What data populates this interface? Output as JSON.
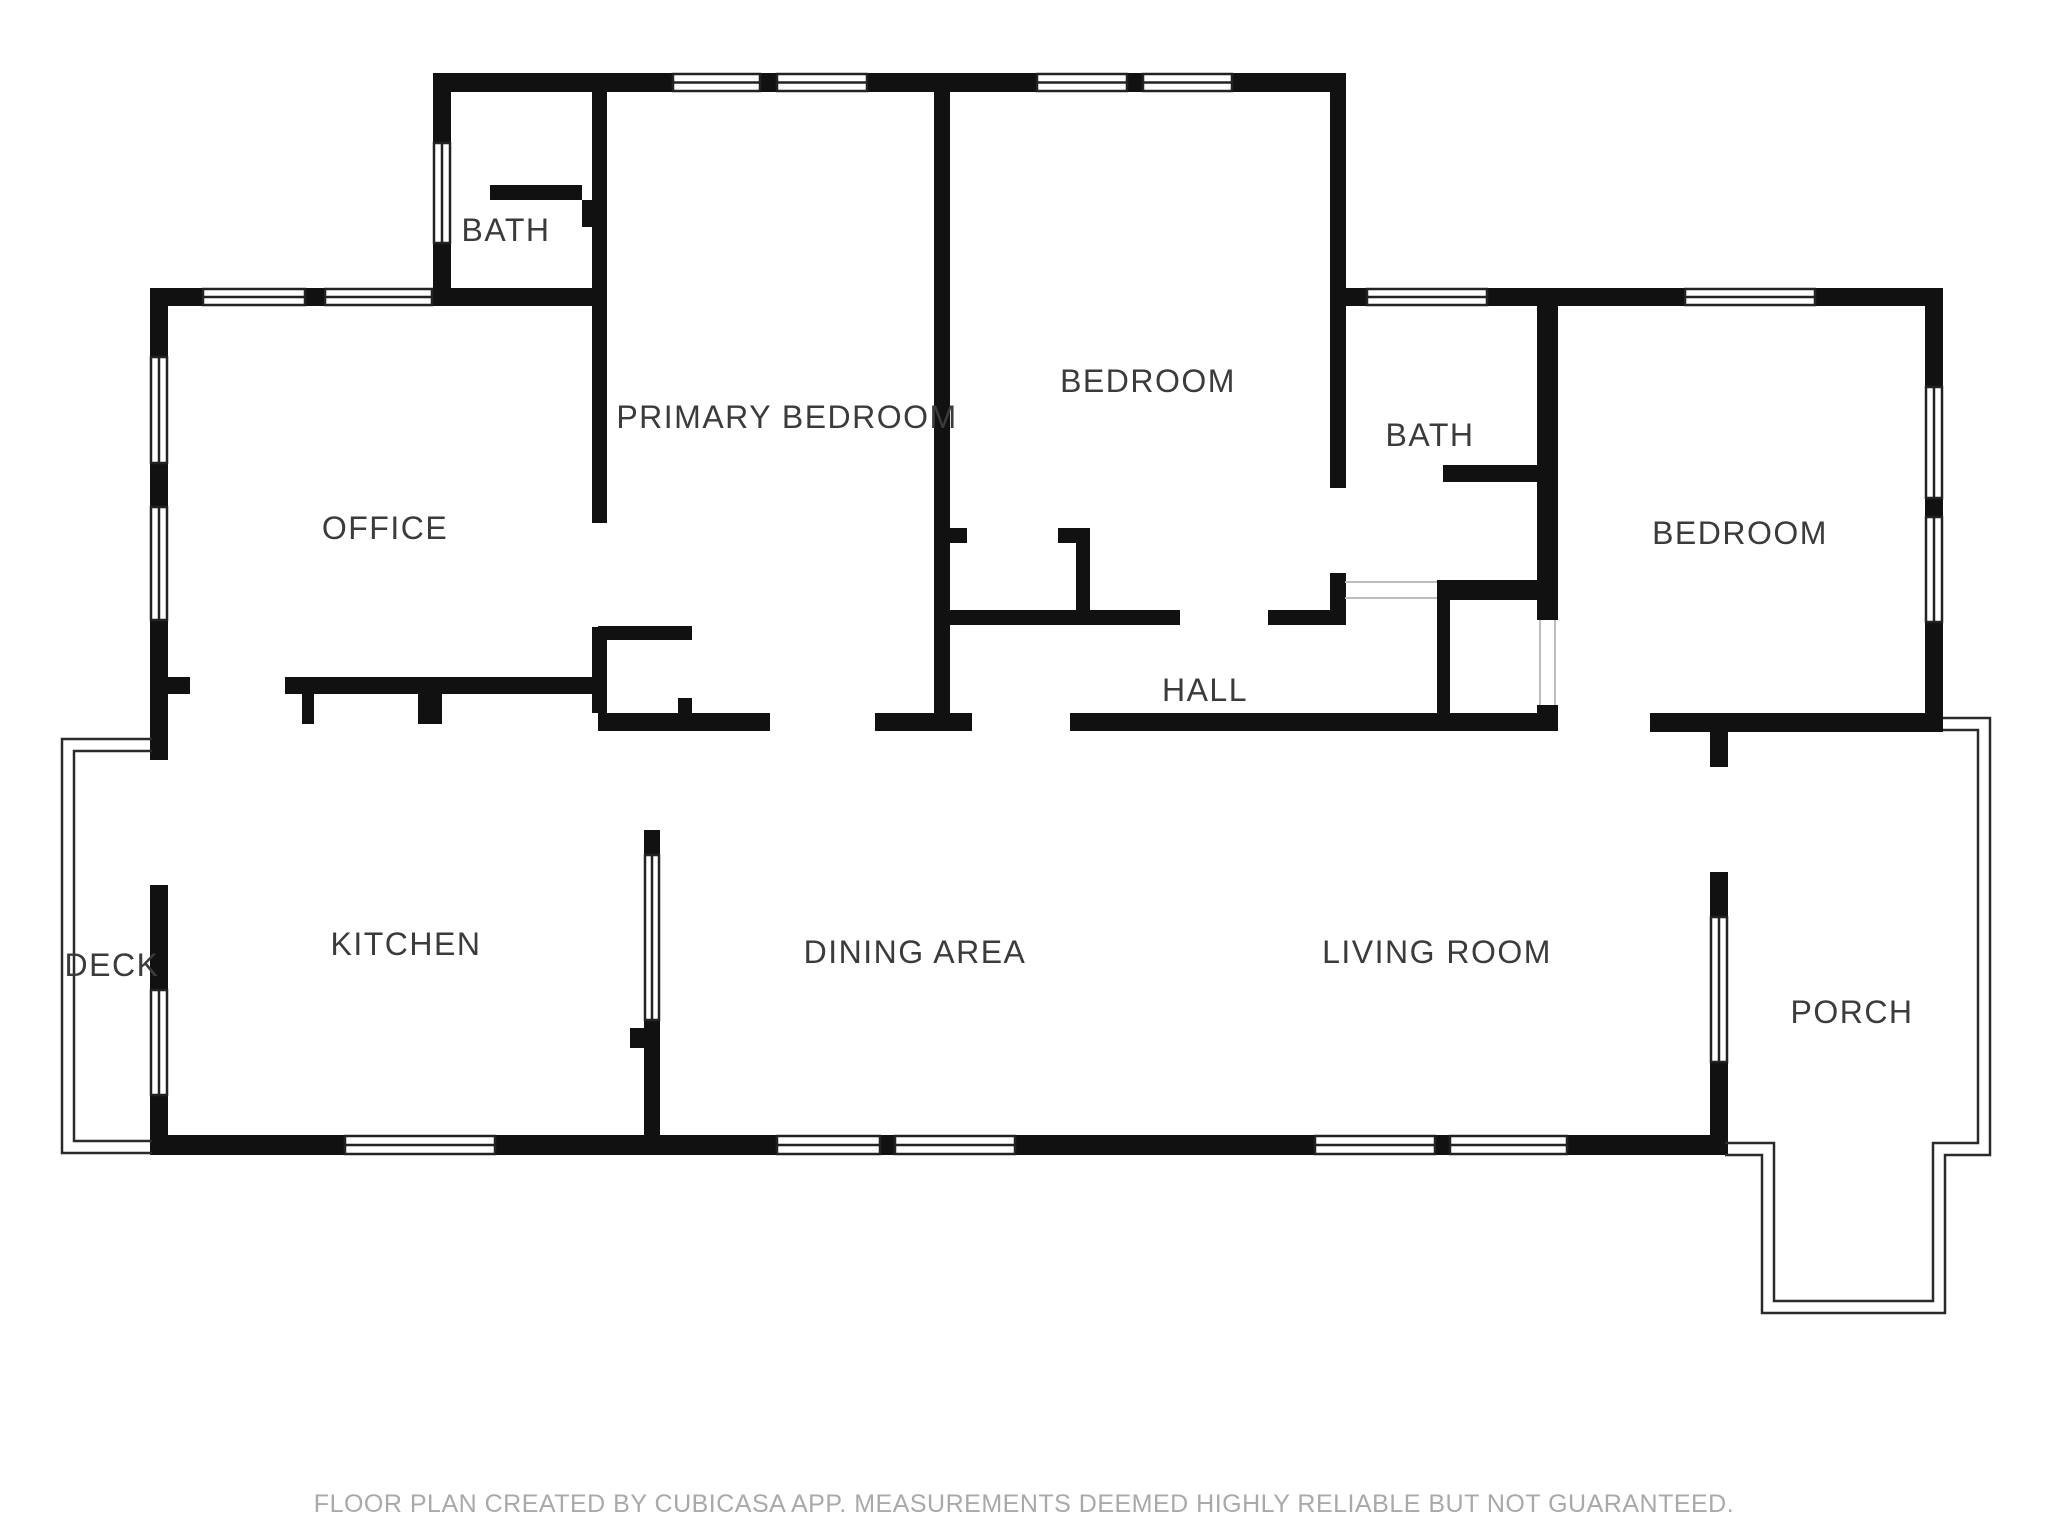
{
  "floor_plan": {
    "app_footer": "FLOOR PLAN CREATED BY CUBICASA APP. MEASUREMENTS DEEMED HIGHLY RELIABLE BUT NOT GUARANTEED.",
    "rooms": {
      "bath_upper": "BATH",
      "office": "OFFICE",
      "primary_bedroom": "PRIMARY BEDROOM",
      "bedroom_top": "BEDROOM",
      "bath_right": "BATH",
      "bedroom_right": "BEDROOM",
      "hall": "HALL",
      "deck": "DECK",
      "kitchen": "KITCHEN",
      "dining_area": "DINING AREA",
      "living_room": "LIVING ROOM",
      "porch": "PORCH"
    },
    "colors": {
      "wall": "#111111",
      "window_frame": "#222222",
      "thin_outline": "#2a2a2a",
      "opening_line": "#bdbdbd",
      "label_text": "#3b3b3b",
      "footer_text": "#a9a9a9",
      "background": "#ffffff"
    }
  }
}
